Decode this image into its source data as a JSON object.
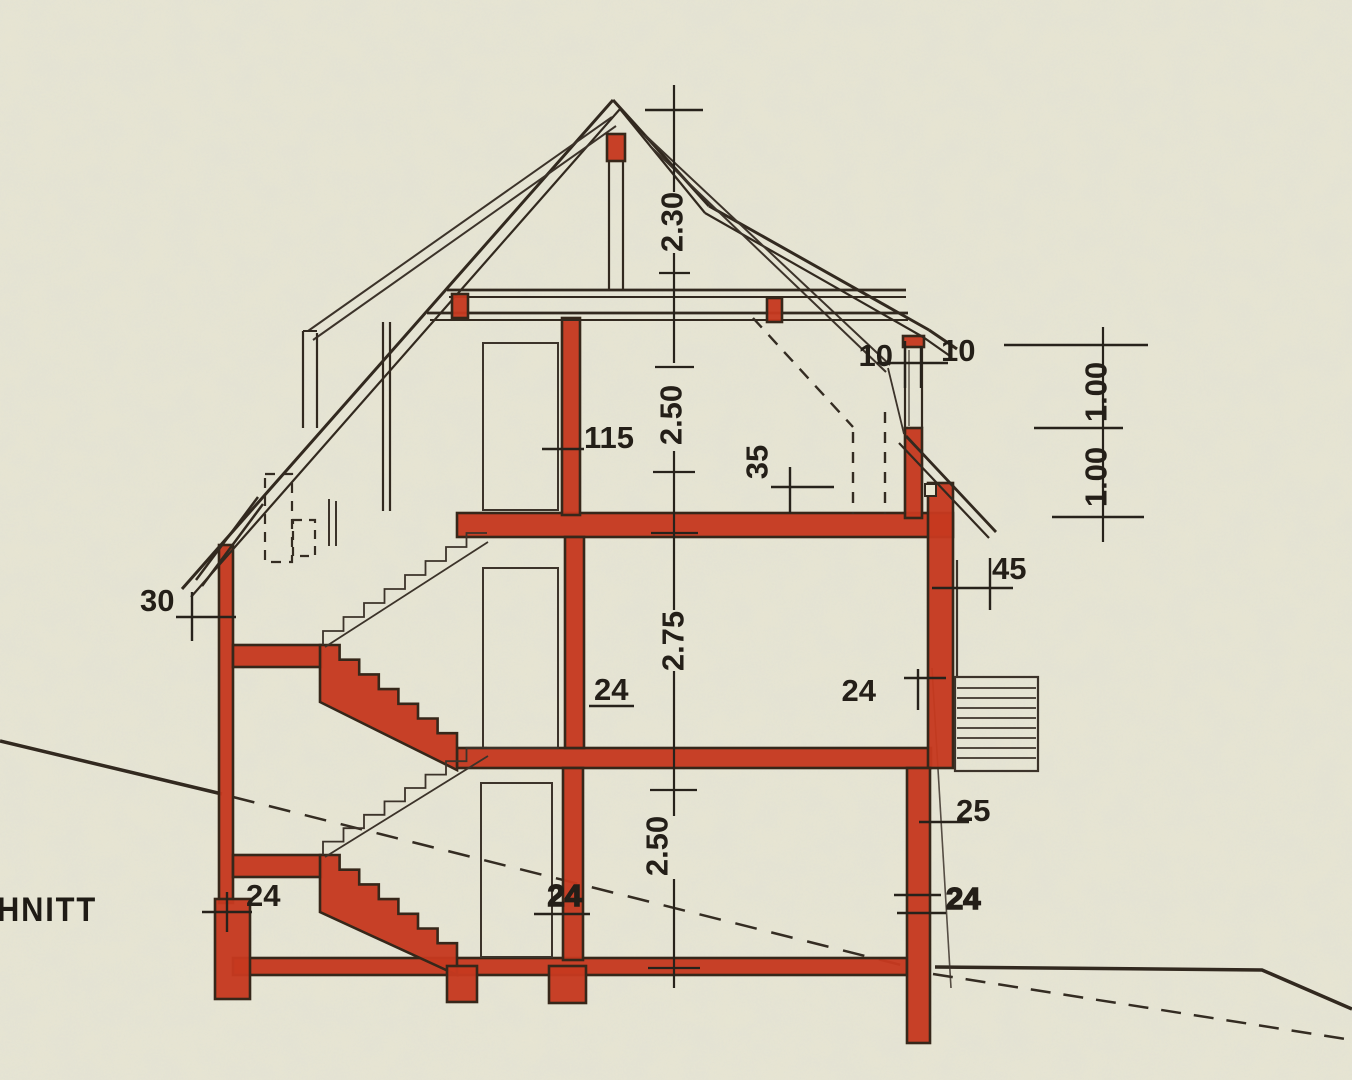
{
  "title": {
    "text": "HNITT"
  },
  "colors": {
    "paper": "#e9e6d2",
    "masonry_red": "#c6391f",
    "line": "#32291f",
    "text": "#241f18"
  },
  "dims": {
    "heights": [
      "2.30",
      "2.50",
      "2.75",
      "2.50"
    ],
    "right_heights": [
      "1.00",
      "1.00"
    ],
    "left_wall": "30",
    "landing": "24",
    "attic_partition": "115",
    "roof_edge": "35",
    "knee_left": "10",
    "knee_right": "10",
    "annex_parapet": "45",
    "first_center": "24",
    "first_right": "24",
    "ground_center": "24",
    "right_lower": "25",
    "ground_right": "24"
  }
}
